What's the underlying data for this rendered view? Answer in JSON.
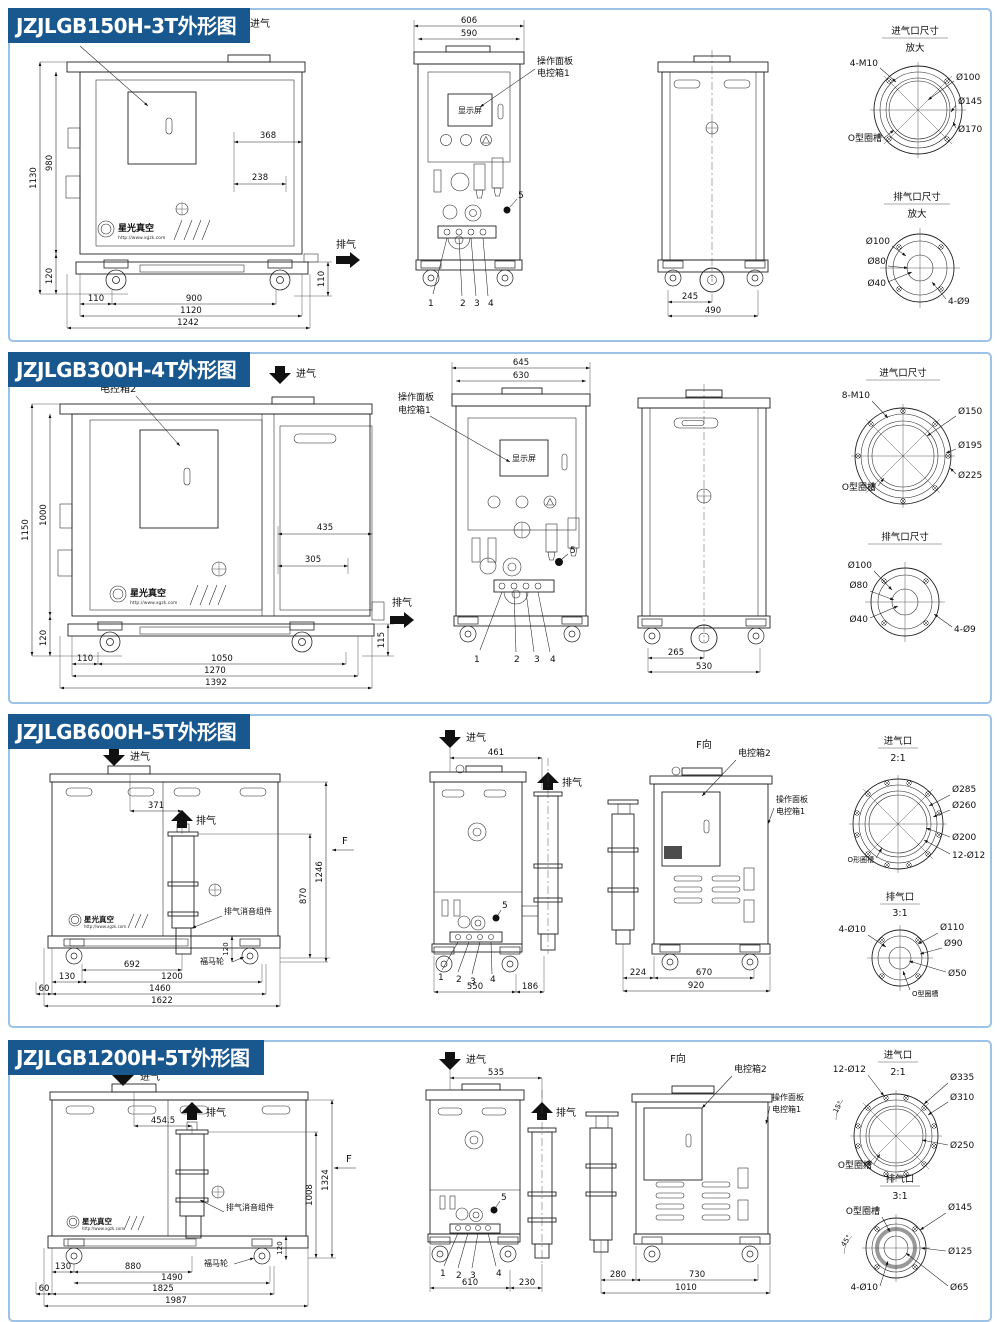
{
  "colors": {
    "title_bg": "#19578F",
    "panel_border": "#9CC2E5",
    "line": "#1a1a1a"
  },
  "common": {
    "intake": "进气",
    "exhaust": "排气",
    "box2": "电控箱2",
    "panel1_l1": "操作面板",
    "panel1_l2": "电控箱1",
    "display": "显示屏",
    "f": "F",
    "f_view": "F向",
    "silencer": "排气消音组件",
    "caster": "福马轮",
    "brand": "星光真空",
    "brand_url": "http://www.xgzk.com",
    "c1": "1",
    "c2": "2",
    "c3": "3",
    "c4": "4",
    "c5": "5"
  },
  "rows": [
    {
      "title": "JZJLGB150H-3T外形图",
      "front": {
        "h1": "1130",
        "h2": "980",
        "w1": "368",
        "w2": "238",
        "hb": "120",
        "hr": "110",
        "b1": "110",
        "b2": "900",
        "b3": "1120",
        "b4": "1242"
      },
      "mid": {
        "w1": "606",
        "w2": "590"
      },
      "side": {
        "b1": "245",
        "b2": "490"
      },
      "intake": {
        "title": "进气口尺寸",
        "scale": "放大",
        "bolt": "4-M10",
        "d1": "Ø100",
        "d2": "Ø145",
        "d3": "Ø170",
        "oring": "O型圈槽"
      },
      "exhaust": {
        "title": "排气口尺寸",
        "scale": "放大",
        "d1": "Ø100",
        "d2": "Ø80",
        "d3": "Ø40",
        "bolt": "4-Ø9"
      }
    },
    {
      "title": "JZJLGB300H-4T外形图",
      "front": {
        "h1": "1150",
        "h2": "1000",
        "w1": "435",
        "w2": "305",
        "hb": "120",
        "hr": "115",
        "b1": "110",
        "b2": "1050",
        "b3": "1270",
        "b4": "1392"
      },
      "mid": {
        "w1": "645",
        "w2": "630"
      },
      "side": {
        "b1": "265",
        "b2": "530"
      },
      "intake": {
        "title": "进气口尺寸",
        "bolt": "8-M10",
        "d1": "Ø150",
        "d2": "Ø195",
        "d3": "Ø225",
        "oring": "O型圈槽"
      },
      "exhaust": {
        "title": "排气口尺寸",
        "d1": "Ø100",
        "d2": "Ø80",
        "d3": "Ø40",
        "bolt": "4-Ø9"
      }
    },
    {
      "title": "JZJLGB600H-5T外形图",
      "front": {
        "w1": "371",
        "v1": "870",
        "v2": "1246",
        "hb": "120",
        "b0": "130",
        "b1": "692",
        "b2": "1200",
        "b3": "1460",
        "b4": "1622",
        "be": "60"
      },
      "mid": {
        "w1": "461",
        "b1": "550",
        "b2": "186"
      },
      "fview": {
        "b0": "224",
        "b1": "670",
        "b2": "920"
      },
      "intake": {
        "title": "进气口",
        "scale": "2:1",
        "d1": "Ø285",
        "d2": "Ø260",
        "d3": "Ø200",
        "bolt": "12-Ø12",
        "oring": "O形圈槽"
      },
      "exhaust": {
        "title": "排气口",
        "scale": "3:1",
        "bolt": "4-Ø10",
        "d1": "Ø110",
        "d2": "Ø90",
        "d3": "Ø50",
        "oring": "O型圈槽"
      }
    },
    {
      "title": "JZJLGB1200H-5T外形图",
      "front": {
        "w1": "454.5",
        "v1": "1008",
        "v2": "1324",
        "hb": "120",
        "b0": "130",
        "b1": "880",
        "b2": "1490",
        "b3": "1825",
        "b4": "1987",
        "be": "60"
      },
      "mid": {
        "w1": "535",
        "b1": "610",
        "b2": "230"
      },
      "fview": {
        "b0": "280",
        "b1": "730",
        "b2": "1010"
      },
      "intake": {
        "title": "进气口",
        "scale": "2:1",
        "bolt": "12-Ø12",
        "angle": "15°",
        "d1": "Ø335",
        "d2": "Ø310",
        "d3": "Ø250",
        "oring": "O型圈槽"
      },
      "exhaust": {
        "title": "排气口",
        "scale": "3:1",
        "oring": "O型圈槽",
        "angle": "45°",
        "d1": "Ø145",
        "d2": "Ø125",
        "d3": "Ø65",
        "bolt": "4-Ø10"
      }
    }
  ]
}
